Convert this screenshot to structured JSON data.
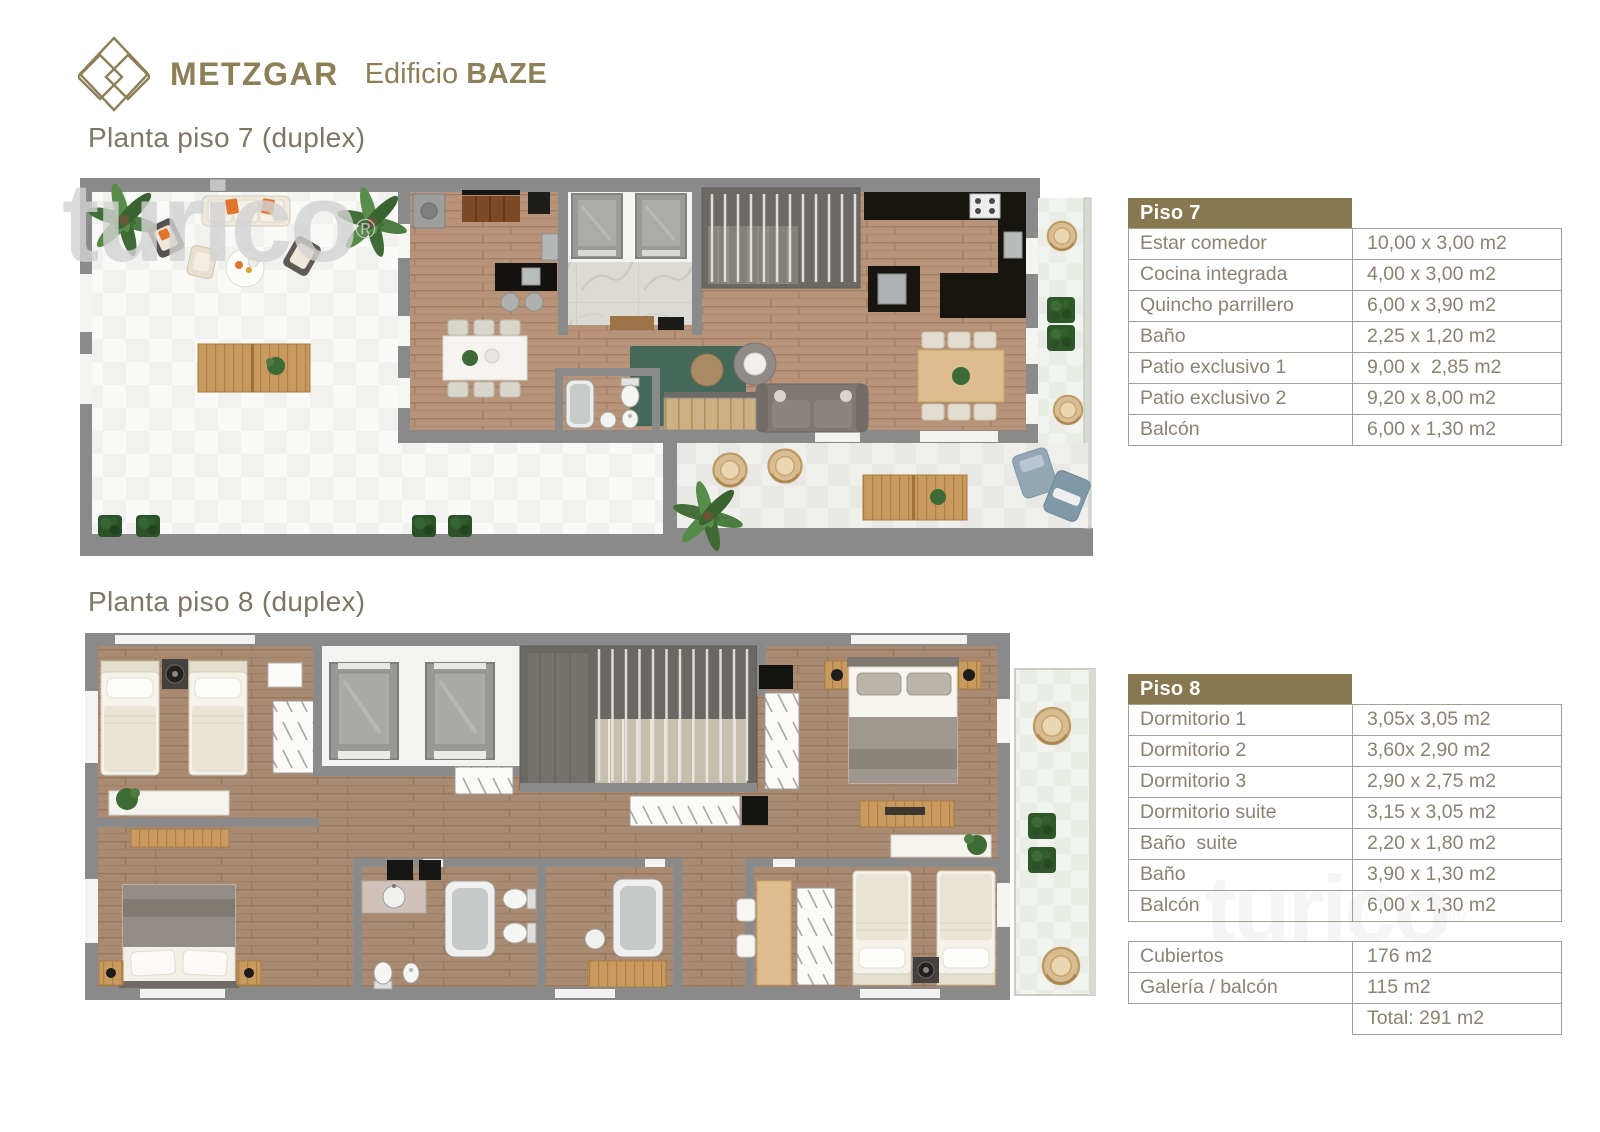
{
  "brand": {
    "name": "METZGAR",
    "building_label": "Edificio",
    "building_name": "BAZE"
  },
  "headings": {
    "plan7": "Planta piso 7 (duplex)",
    "plan8": "Planta piso 8 (duplex)"
  },
  "watermark": {
    "text": "turico",
    "symbol": "®"
  },
  "tables": {
    "piso7": {
      "title": "Piso 7",
      "rows": [
        {
          "label": "Estar comedor",
          "value": "10,00 x 3,00 m2"
        },
        {
          "label": "Cocina integrada",
          "value": "4,00 x 3,00 m2"
        },
        {
          "label": "Quincho parrillero",
          "value": "6,00 x 3,90 m2"
        },
        {
          "label": "Baño",
          "value": "2,25 x 1,20 m2"
        },
        {
          "label": "Patio exclusivo 1",
          "value": "9,00 x  2,85 m2"
        },
        {
          "label": "Patio exclusivo 2",
          "value": "9,20 x 8,00 m2"
        },
        {
          "label": "Balcón",
          "value": "6,00 x 1,30 m2"
        }
      ]
    },
    "piso8": {
      "title": "Piso 8",
      "rows": [
        {
          "label": "Dormitorio 1",
          "value": "3,05x 3,05 m2"
        },
        {
          "label": "Dormitorio 2",
          "value": "3,60x 2,90 m2"
        },
        {
          "label": "Dormitorio 3",
          "value": "2,90 x 2,75 m2"
        },
        {
          "label": "Dormitorio suite",
          "value": "3,15 x 3,05 m2"
        },
        {
          "label": "Baño  suite",
          "value": "2,20 x 1,80 m2"
        },
        {
          "label": "Baño",
          "value": "3,90 x 1,30 m2"
        },
        {
          "label": "Balcón",
          "value": "6,00 x 1,30 m2"
        }
      ]
    },
    "summary": {
      "rows": [
        {
          "label": "Cubiertos",
          "value": "176 m2"
        },
        {
          "label": "Galería / balcón",
          "value": "115 m2"
        }
      ],
      "total_label": "Total: 291 m2"
    }
  },
  "colors": {
    "brand": "#8d7f58",
    "heading_text": "#7d7764",
    "table_text": "#8b8271",
    "table_header_bg": "#877850",
    "table_border": "#a49f92",
    "wall": "#8a8a8a",
    "wood_floor_7": "#b79479",
    "wood_floor_8": "#a98a72",
    "patio_tile": "#f2f2f0",
    "balcony_tile": "#eaeee6",
    "counter_granite": "#17150f",
    "plant_green": "#3d6a35",
    "accent_orange": "#e0752b"
  }
}
